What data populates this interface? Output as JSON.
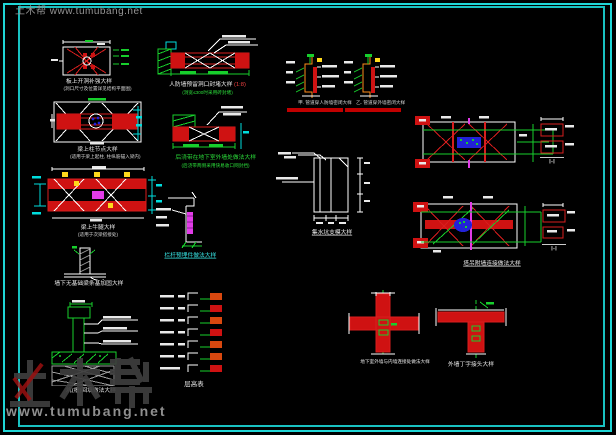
{
  "watermarks": {
    "top": "土木帮 www.tumubang.net",
    "logo": "土木帮",
    "url": "www.tumubang.net"
  },
  "palette": {
    "background": "#000000",
    "border_cyan": "#1fd6d6",
    "line_red": "#d81e1e",
    "line_green": "#17cf2c",
    "line_cyan": "#00dede",
    "line_magenta": "#e23ce8",
    "line_yellow": "#ffd91c",
    "fill_blue": "#2222d8",
    "watermark_gray": "#8f8f8f"
  },
  "details": {
    "beam_opening_top": {
      "title": "板上开洞补强大样",
      "note": "(洞口尺寸及位置详见结构平面图)"
    },
    "wall_opening_seal": {
      "title": "人防墙预留洞口封堵大样",
      "scale": "(1:8)",
      "note": "(洞宽≤300时采用砖封堵)"
    },
    "pipe_seal_a": {
      "title": "甲. 管道穿人防墙密闭大样"
    },
    "pipe_seal_b": {
      "title": "乙. 管道穿外墙密闭大样"
    },
    "beam_column": {
      "title": "梁上柱节点大样",
      "note": "(适用于梁上起柱, 柱纵筋锚入梁内)"
    },
    "post_pour": {
      "title": "后浇带在地下室外墙处做法大样",
      "note": "(后浇带两侧采用快易收口网封挡)"
    },
    "beam_strengthen": {
      "title": "梁上牛腿大样",
      "note": "(适用于次梁搭接处)"
    },
    "cantilever": {
      "title": "栏杆预埋件做法大样"
    },
    "strip_footing": {
      "title": "墙下无基础梁条基加固大样"
    },
    "pit_backfill": {
      "title": "坑(槽)回填做法大样"
    },
    "floor_table": {
      "title": "层高表"
    },
    "sump_pit": {
      "title": "集水坑支模大样"
    },
    "tower_tie_1": {
      "section": "Ⅰ-Ⅰ"
    },
    "tower_tie_2": {
      "title": "塔吊附墙连接做法大样",
      "section": "Ⅰ-Ⅰ"
    },
    "wall_cross": {
      "title": "地下室外墙与内墙连接处做法大样"
    },
    "wall_tee": {
      "title": "外墙丁字接头大样"
    }
  }
}
